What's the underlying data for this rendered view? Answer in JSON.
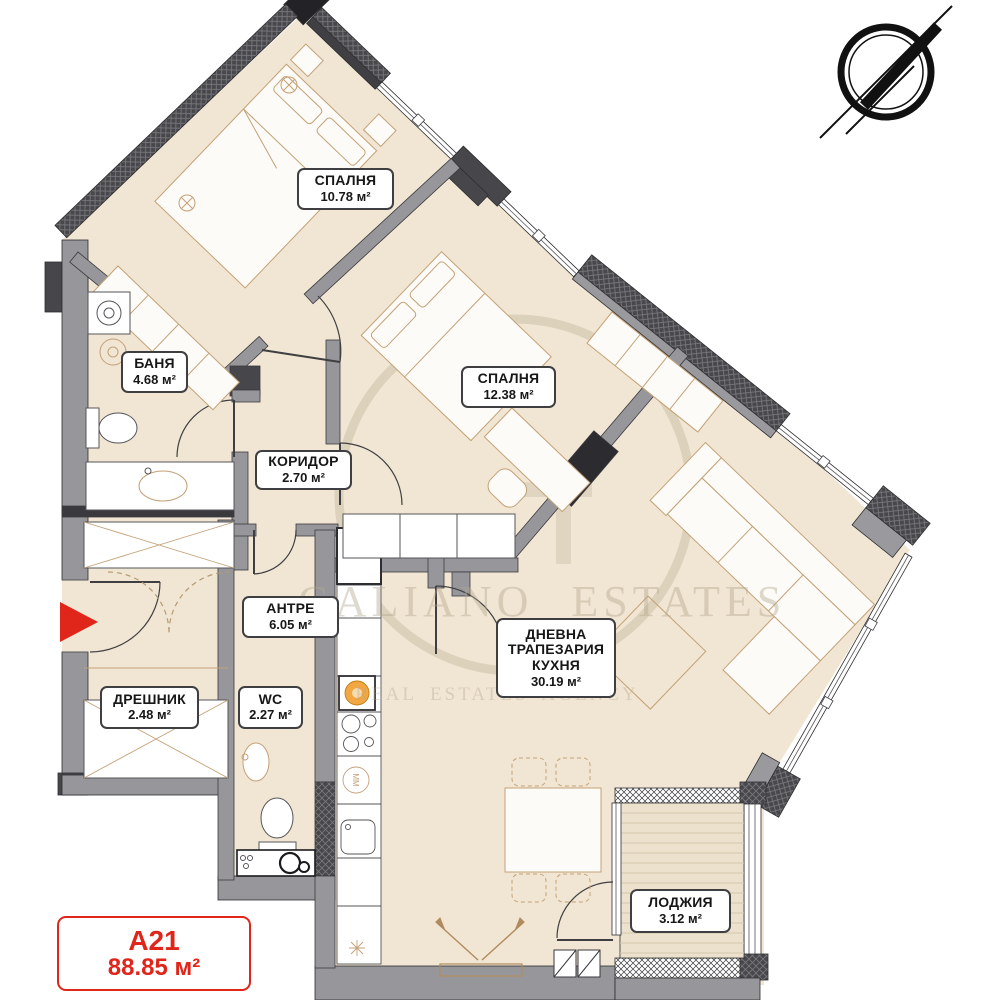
{
  "unit": {
    "code": "A21",
    "area": "88.85 м²"
  },
  "rooms": [
    {
      "name": "СПАЛНЯ",
      "area": "10.78 м²"
    },
    {
      "name": "СПАЛНЯ",
      "area": "12.38 м²"
    },
    {
      "name": "БАНЯ",
      "area": "4.68 м²"
    },
    {
      "name": "КОРИДОР",
      "area": "2.70 м²"
    },
    {
      "name": "АНТРЕ",
      "area": "6.05 м²"
    },
    {
      "name": "ДРЕШНИК",
      "area": "2.48 м²"
    },
    {
      "name": "WC",
      "area": "2.27 м²"
    },
    {
      "name": "ДНЕВНА ТРАПЕЗАРИЯ КУХНЯ",
      "area": "30.19 м²"
    },
    {
      "name": "ЛОДЖИЯ",
      "area": "3.12 м²"
    }
  ],
  "watermark": {
    "line1": "GALIANO ESTATES",
    "line2": "REAL ESTATES AGENCY"
  },
  "labels": {
    "washer": "MM"
  },
  "icons": {
    "north": "north-arrow-compass",
    "entrance": "entrance-arrow"
  },
  "colors": {
    "accent_red": "#e0251a",
    "floor": "#f1e6d3",
    "wall": "#97979b",
    "wall_dark": "#46464b",
    "furniture_line": "#c3a177"
  }
}
